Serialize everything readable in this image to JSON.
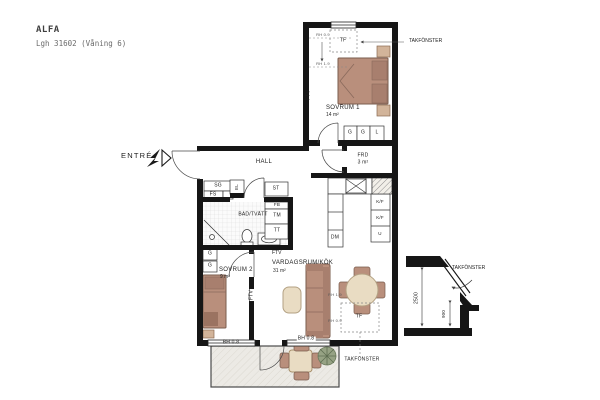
{
  "title": {
    "name": "ALFA",
    "subtitle": "Lgh 31602 (Våning 6)"
  },
  "entrance": {
    "label": "ENTRÉ"
  },
  "rooms": {
    "hall": {
      "name": "HALL"
    },
    "sovrum1": {
      "name": "SOVRUM 1",
      "area": "14 m²"
    },
    "sovrum2": {
      "name": "SOVRUM 2",
      "area": "9 m²"
    },
    "vardagsrum_kok": {
      "name": "VARDAGSRUM/KÖK",
      "area": "31 m²"
    },
    "bad_tvatt": {
      "name": "BAD/TVÄTT"
    },
    "forrad": {
      "name": "FRD",
      "area": "3 m²"
    },
    "balkong": {
      "name": "BALKONG",
      "area": "ca 7 m²"
    }
  },
  "fixtures": {
    "sg": "SG",
    "fs": "FS",
    "el": "EL",
    "st": "ST",
    "fb": "FB",
    "tm": "TM",
    "tt": "TT",
    "dm": "DM",
    "kf_upper": "K/F",
    "kf_lower": "K/F",
    "ugn": "U",
    "garderob_sov1_1": "G",
    "garderob_sov1_2": "G",
    "linne_sov1": "L",
    "garderob_sov2_1": "G",
    "garderob_sov2_2": "G"
  },
  "annotations": {
    "tf_sov1": "TF",
    "tf_living": "TF",
    "ftv_sov1": "FTV",
    "ftv_wall": "FTV",
    "ftv_living": "FTV",
    "bh_window_sov2": "BH 0.8",
    "bh_window_living": "BH 0.8",
    "rh_sov1_upper": "RH 0.9",
    "rh_sov1_lower": "RH 1.9",
    "rh_living_upper": "RH 1.9",
    "rh_living_lower": "RH 0.9",
    "takfonster_sov1": "TAKFÖNSTER",
    "takfonster_living": "TAKFÖNSTER",
    "takfonster_section": "TAKFÖNSTER",
    "dim_2500": "2500",
    "dim_900": "900"
  },
  "colors": {
    "wall": "#161616",
    "furniture": "#b98f7c",
    "furniture_dark": "#a87f6e",
    "wood": "#e9dcc3",
    "balcony_floor": "#eceae5",
    "plant": "#96a284"
  }
}
